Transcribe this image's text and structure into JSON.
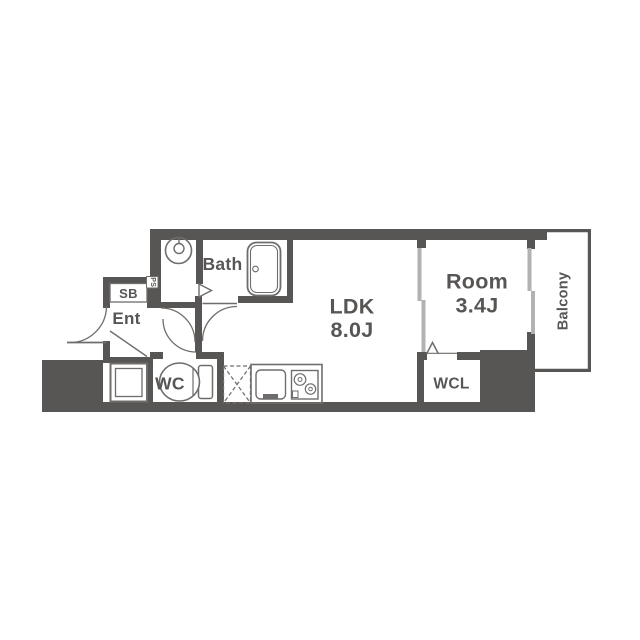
{
  "floorplan": {
    "rooms": {
      "ldk": {
        "name": "LDK",
        "size": "8.0J"
      },
      "bedroom": {
        "name": "Room",
        "size": "3.4J"
      }
    },
    "labels": {
      "bath": "Bath",
      "wc": "WC",
      "wcl": "WCL",
      "entrance": "Ent",
      "shoe_box": "SB",
      "pipe_space": "PS",
      "balcony": "Balcony"
    },
    "colors": {
      "wall": "#585654",
      "window": "#b2b2b2",
      "fixture": "#6f6d6b",
      "background": "#ffffff"
    }
  }
}
